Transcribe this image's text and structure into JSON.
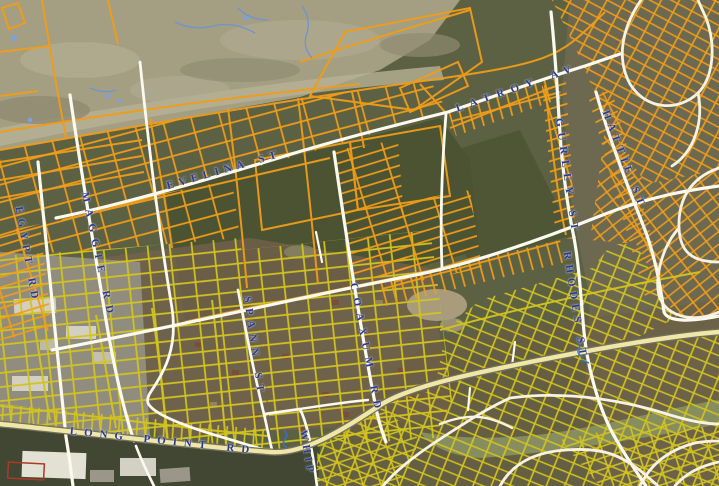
{
  "map": {
    "street_labels": [
      {
        "id": "egypt-rd",
        "text": "EGYPT RD"
      },
      {
        "id": "maggie-rd",
        "text": "MAGGIE RD"
      },
      {
        "id": "evelina-st",
        "text": "EVELINA ST"
      },
      {
        "id": "latroy-av",
        "text": "LATROY AV"
      },
      {
        "id": "spann-st",
        "text": "SPANN ST"
      },
      {
        "id": "coaxum-rd",
        "text": "COAXUM RD"
      },
      {
        "id": "whip-rd",
        "text": "WHIP"
      },
      {
        "id": "gurley-st",
        "text": "GURLEY ST"
      },
      {
        "id": "rhodes-st",
        "text": "RHODES ST"
      },
      {
        "id": "hattie-st",
        "text": "HATTIE ST"
      },
      {
        "id": "long-point-rd",
        "text": "LONG POINT RD"
      }
    ],
    "colors": {
      "parcel_orange": "#f09d18",
      "parcel_yellow": "#d2c41e",
      "road_white": "#fcf9ee",
      "road_subdivision": "#f8f2e2",
      "road_major_fill": "#f0e6a8",
      "road_major_casing": "#72715c",
      "label_blue": "#2b3a91",
      "marsh": "#a49f82",
      "woods": "#49512f",
      "water_blue": "#6f93d2"
    }
  }
}
